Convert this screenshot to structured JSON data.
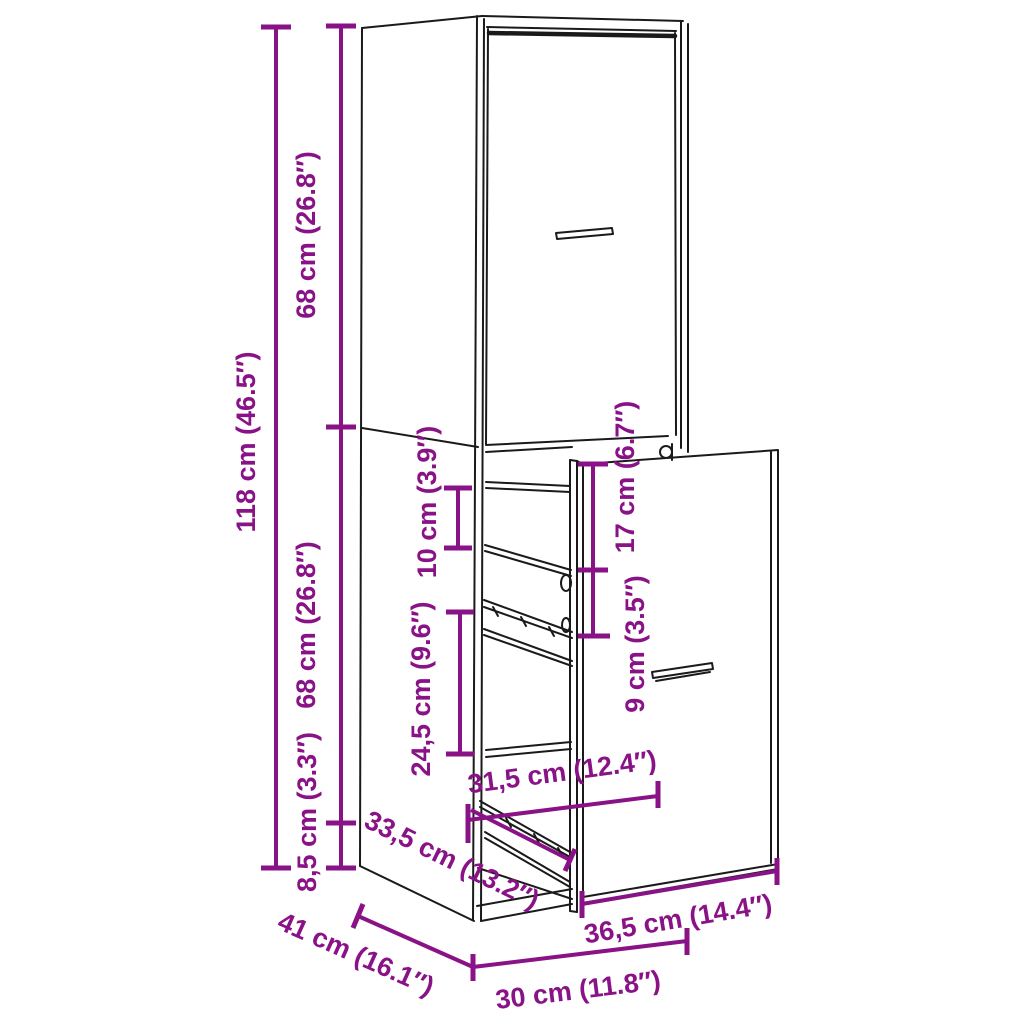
{
  "page": {
    "background": "#ffffff"
  },
  "diagram": {
    "accent_color": "#8A1287",
    "line_color": "#1a1a1a",
    "dims": {
      "d118": "118 cm (46.5″)",
      "d68_top": "68 cm (26.8″)",
      "d68_mid": "68 cm (26.8″)",
      "d8_5": "8,5 cm (3.3″)",
      "d10": "10 cm (3.9″)",
      "d24_5": "24,5 cm (9.6″)",
      "d17": "17 cm (6.7″)",
      "d9": "9 cm (3.5″)",
      "d31_5": "31,5 cm (12.4″)",
      "d33_5": "33,5 cm (13.2″)",
      "d36_5": "36,5 cm (14.4″)",
      "d41": "41 cm (16.1″)",
      "d30": "30 cm (11.8″)"
    }
  }
}
